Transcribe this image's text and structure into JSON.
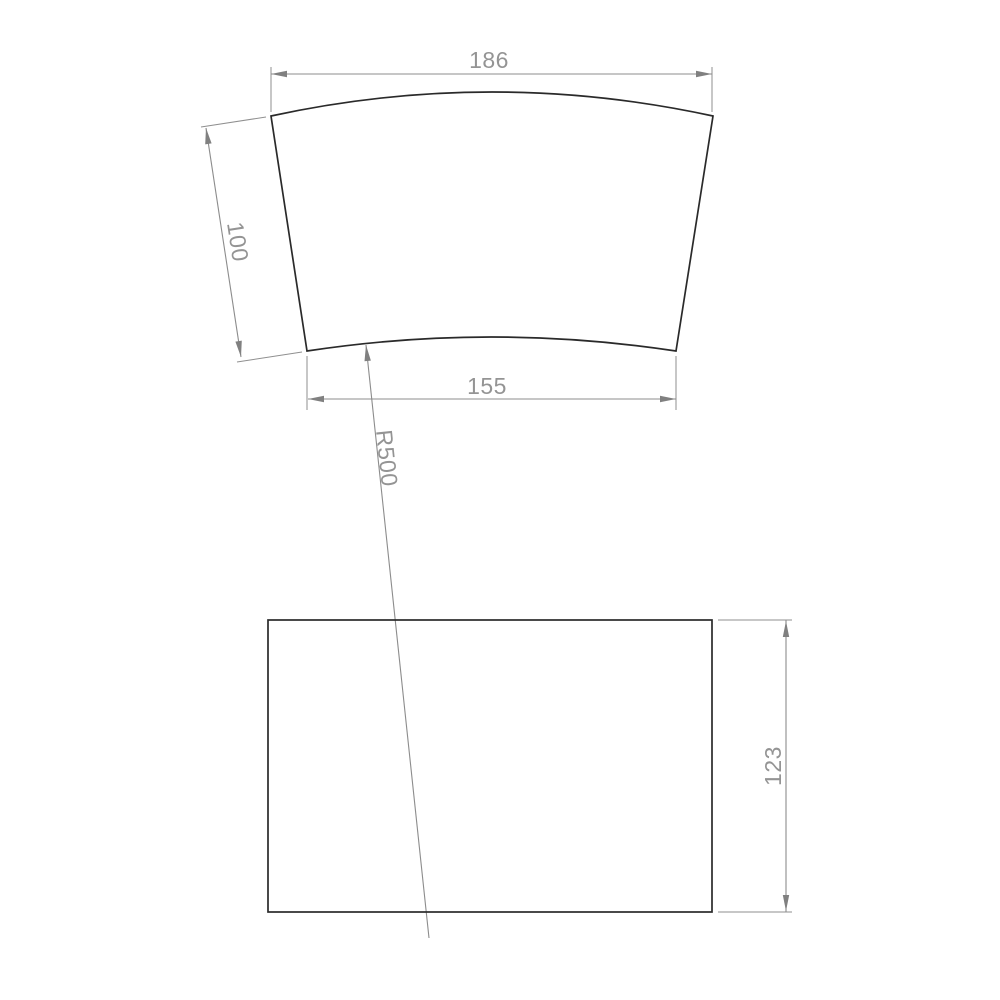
{
  "drawing": {
    "flat_pattern_view": {
      "dim_top_width": "186",
      "dim_slant_height": "100",
      "dim_bottom_width": "155",
      "dim_radius": "R500"
    },
    "rectangle_view": {
      "dim_height": "123"
    },
    "colors": {
      "background": "#ffffff",
      "part_outline": "#2a2a2a",
      "dimension_lines": "#8c8c8c",
      "dimension_text": "#949494"
    }
  }
}
